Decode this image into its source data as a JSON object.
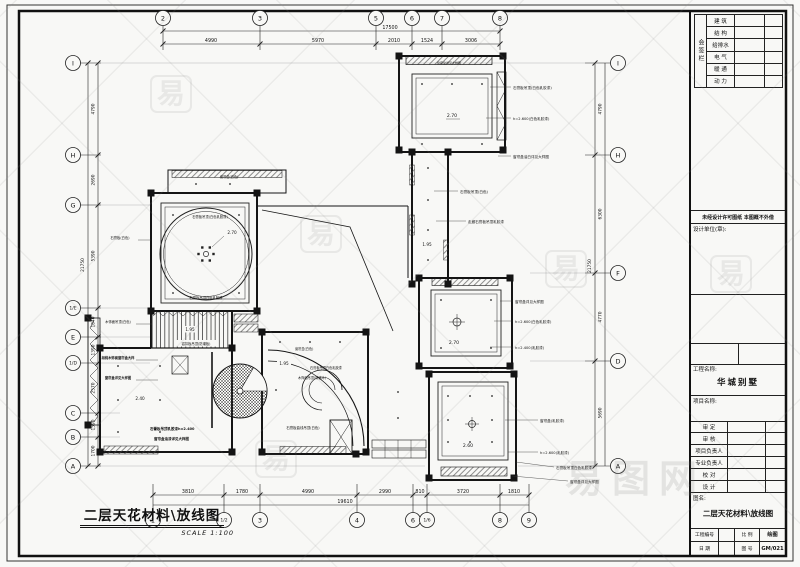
{
  "caption": {
    "title": "二层天花材料\\放线图",
    "scale": "SCALE 1:100"
  },
  "title_block": {
    "signoff_label": "会签栏",
    "signoff_rows": [
      "建 筑",
      "结 构",
      "给排水",
      "电 气",
      "暖 通",
      "动 力"
    ],
    "notice": "未经设计许可图纸 本图概不外借",
    "design_unit_label": "设计单位(章):",
    "project_label": "工程名称:",
    "project_name": "华城别墅",
    "item_label": "项目名称:",
    "sign_rows": [
      "审 定",
      "审 核",
      "项目负责人",
      "专业负责人",
      "校 对",
      "设 计"
    ],
    "drawing_name_label": "图名:",
    "drawing_name": "二层天花材料\\放线图",
    "footer_r1": [
      "工程编号",
      "",
      "比 例",
      "绘图"
    ],
    "footer_r2": [
      "日 期",
      "",
      "图 号",
      "GM/021"
    ]
  },
  "watermark": {
    "char": "易",
    "brand": "易图网"
  },
  "drawing": {
    "bubbles": [
      {
        "l": "2",
        "x": 163,
        "y": 18
      },
      {
        "l": "3",
        "x": 260,
        "y": 18
      },
      {
        "l": "5",
        "x": 376,
        "y": 18
      },
      {
        "l": "6",
        "x": 412,
        "y": 18
      },
      {
        "l": "7",
        "x": 442,
        "y": 18
      },
      {
        "l": "8",
        "x": 500,
        "y": 18
      },
      {
        "l": "1",
        "x": 153,
        "y": 520
      },
      {
        "l": "1/2",
        "x": 224,
        "y": 520,
        "s": 4.5
      },
      {
        "l": "3",
        "x": 260,
        "y": 520
      },
      {
        "l": "4",
        "x": 357,
        "y": 520
      },
      {
        "l": "6",
        "x": 413,
        "y": 520
      },
      {
        "l": "1/6",
        "x": 427,
        "y": 520,
        "s": 4.5
      },
      {
        "l": "8",
        "x": 500,
        "y": 520
      },
      {
        "l": "9",
        "x": 529,
        "y": 520
      },
      {
        "l": "I",
        "x": 73,
        "y": 63
      },
      {
        "l": "H",
        "x": 73,
        "y": 155
      },
      {
        "l": "G",
        "x": 73,
        "y": 205
      },
      {
        "l": "1/E",
        "x": 73,
        "y": 308,
        "s": 4.5
      },
      {
        "l": "E",
        "x": 73,
        "y": 337
      },
      {
        "l": "1/D",
        "x": 73,
        "y": 363,
        "s": 4.5
      },
      {
        "l": "C",
        "x": 73,
        "y": 413
      },
      {
        "l": "B",
        "x": 73,
        "y": 437
      },
      {
        "l": "A",
        "x": 73,
        "y": 466
      },
      {
        "l": "I",
        "x": 618,
        "y": 63
      },
      {
        "l": "H",
        "x": 618,
        "y": 155
      },
      {
        "l": "F",
        "x": 618,
        "y": 273
      },
      {
        "l": "D",
        "x": 618,
        "y": 361
      },
      {
        "l": "A",
        "x": 618,
        "y": 466
      }
    ],
    "texts": [
      {
        "t": "17500",
        "x": 390,
        "y": 29,
        "s": 4.8
      },
      {
        "t": "4990",
        "x": 211,
        "y": 42,
        "s": 4.8
      },
      {
        "t": "5970",
        "x": 318,
        "y": 42,
        "s": 4.8
      },
      {
        "t": "2010",
        "x": 394,
        "y": 42,
        "s": 4.8
      },
      {
        "t": "1524",
        "x": 427,
        "y": 42,
        "s": 4.8
      },
      {
        "t": "3006",
        "x": 471,
        "y": 42,
        "s": 4.8
      },
      {
        "t": "19610",
        "x": 345,
        "y": 503,
        "s": 4.8
      },
      {
        "t": "3810",
        "x": 188,
        "y": 493,
        "s": 4.8
      },
      {
        "t": "1780",
        "x": 242,
        "y": 493,
        "s": 4.8
      },
      {
        "t": "4990",
        "x": 308,
        "y": 493,
        "s": 4.8
      },
      {
        "t": "2990",
        "x": 385,
        "y": 493,
        "s": 4.8
      },
      {
        "t": "810",
        "x": 420,
        "y": 493,
        "s": 4.8
      },
      {
        "t": "3720",
        "x": 463,
        "y": 493,
        "s": 4.8
      },
      {
        "t": "1810",
        "x": 514,
        "y": 493,
        "s": 4.8
      },
      {
        "t": "4790",
        "x": 94.5,
        "y": 109,
        "s": 4.3,
        "rot": -90
      },
      {
        "t": "2690",
        "x": 94.5,
        "y": 180,
        "s": 4.3,
        "rot": -90
      },
      {
        "t": "5390",
        "x": 94.5,
        "y": 256,
        "s": 4.3,
        "rot": -90
      },
      {
        "t": "21750",
        "x": 84,
        "y": 265,
        "s": 4.3,
        "rot": -90
      },
      {
        "t": "1640",
        "x": 94.5,
        "y": 322,
        "s": 4.3,
        "rot": -90
      },
      {
        "t": "1390",
        "x": 94.5,
        "y": 350,
        "s": 4.3,
        "rot": -90
      },
      {
        "t": "2570",
        "x": 94.5,
        "y": 388,
        "s": 4.3,
        "rot": -90
      },
      {
        "t": "1590",
        "x": 94.5,
        "y": 425,
        "s": 4.3,
        "rot": -90
      },
      {
        "t": "1700",
        "x": 94.5,
        "y": 451,
        "s": 4.3,
        "rot": -90
      },
      {
        "t": "4790",
        "x": 601.5,
        "y": 109,
        "s": 4.3,
        "rot": -90
      },
      {
        "t": "6300",
        "x": 601.5,
        "y": 214,
        "s": 4.3,
        "rot": -90
      },
      {
        "t": "21750",
        "x": 591,
        "y": 266,
        "s": 4.3,
        "rot": -90
      },
      {
        "t": "4770",
        "x": 601.5,
        "y": 317,
        "s": 4.3,
        "rot": -90
      },
      {
        "t": "5690",
        "x": 601.5,
        "y": 413,
        "s": 4.3,
        "rot": -90
      },
      {
        "t": "2.70",
        "x": 452,
        "y": 117,
        "s": 4.6
      },
      {
        "t": "1.95",
        "x": 427,
        "y": 246,
        "s": 4.2
      },
      {
        "t": "2.70",
        "x": 454,
        "y": 344,
        "s": 4.6
      },
      {
        "t": "2.60",
        "x": 468,
        "y": 447,
        "s": 4.6
      },
      {
        "t": "2.70",
        "x": 232,
        "y": 234,
        "s": 4.2
      },
      {
        "t": "1.95",
        "x": 190,
        "y": 331,
        "s": 4.2,
        "bg": 14
      },
      {
        "t": "2.40",
        "x": 140,
        "y": 400,
        "s": 4.2
      },
      {
        "t": "1.95",
        "x": 284,
        "y": 365,
        "s": 4.2,
        "bg": 14
      },
      {
        "t": "窗帘盒详见大样图",
        "x": 449,
        "y": 64,
        "s": 3
      },
      {
        "t": "石膏板吊顶(白色乳胶漆)",
        "x": 513,
        "y": 89,
        "s": 3.6,
        "a": "start"
      },
      {
        "t": "h=2.600(白色乳胶漆)",
        "x": 513,
        "y": 120,
        "s": 3.6,
        "a": "start"
      },
      {
        "t": "窗帘盒油白详见大样图",
        "x": 513,
        "y": 158,
        "s": 3.6,
        "a": "start"
      },
      {
        "t": "石膏板吊顶(白色)",
        "x": 460,
        "y": 193,
        "s": 3.6,
        "a": "start"
      },
      {
        "t": "走廊石膏板吊顶乳胶漆",
        "x": 468,
        "y": 223,
        "s": 3.6,
        "a": "start"
      },
      {
        "t": "窗帘盒详见大样图",
        "x": 515,
        "y": 303,
        "s": 3.6,
        "a": "start"
      },
      {
        "t": "h=2.600(白色乳胶漆)",
        "x": 515,
        "y": 323,
        "s": 3.6,
        "a": "start"
      },
      {
        "t": "h=2.400(乳胶漆)",
        "x": 515,
        "y": 349,
        "s": 3.6,
        "a": "start"
      },
      {
        "t": "窗帘盒(乳胶漆)",
        "x": 540,
        "y": 422,
        "s": 3.6,
        "a": "start"
      },
      {
        "t": "h=2.600(乳胶漆)",
        "x": 540,
        "y": 454,
        "s": 3.6,
        "a": "start"
      },
      {
        "t": "石膏板吊顶白色乳胶漆",
        "x": 556,
        "y": 469,
        "s": 3.6,
        "a": "start"
      },
      {
        "t": "窗帘盒详见大样图",
        "x": 570,
        "y": 483,
        "s": 3.6,
        "a": "start"
      },
      {
        "t": "石膏板吊顶(白色乳胶漆)",
        "x": 210,
        "y": 218,
        "s": 3.3
      },
      {
        "t": "石膏板吊顶白色乳胶漆",
        "x": 206,
        "y": 299,
        "s": 3.3
      },
      {
        "t": "窗帘盒(白色)",
        "x": 220,
        "y": 178,
        "s": 3.2,
        "a": "start"
      },
      {
        "t": "石膏板(白色)",
        "x": 120,
        "y": 239,
        "s": 3.3
      },
      {
        "t": "木饰面吊顶(白色)",
        "x": 118,
        "y": 323,
        "s": 3.3
      },
      {
        "t": "胡桃木饰面窗帘盒大样",
        "x": 118,
        "y": 359,
        "s": 3.3,
        "b": 1
      },
      {
        "t": "窗帘盒详见大样图",
        "x": 118,
        "y": 379,
        "s": 3.3,
        "b": 1
      },
      {
        "t": "铝扣板吊顶(防潮板)",
        "x": 196,
        "y": 345,
        "s": 3.3,
        "bg": 42
      },
      {
        "t": "石膏板吊顶乳胶漆h=2.400",
        "x": 150,
        "y": 430,
        "s": 3.5,
        "a": "start",
        "b": 1
      },
      {
        "t": "窗帘盒油漆详见大样图",
        "x": 154,
        "y": 440,
        "s": 3.5,
        "a": "start",
        "b": 1
      },
      {
        "t": "窗帘盒(白色)",
        "x": 295,
        "y": 350,
        "s": 3.2,
        "a": "start"
      },
      {
        "t": "石膏板吊顶白色乳胶漆",
        "x": 310,
        "y": 369,
        "s": 3.2,
        "a": "start"
      },
      {
        "t": "木饰面吊顶(胡桃木)",
        "x": 298,
        "y": 379,
        "s": 3.2,
        "a": "start"
      },
      {
        "t": "石膏板曲线吊顶(白色)",
        "x": 303,
        "y": 429,
        "s": 3.4,
        "bg": 46
      }
    ]
  }
}
